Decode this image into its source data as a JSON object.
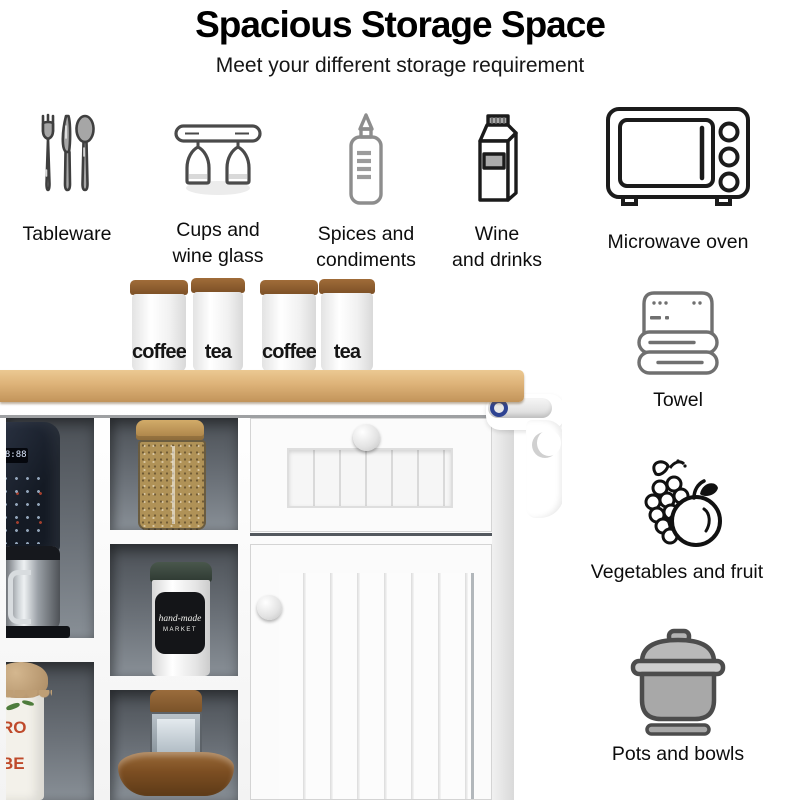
{
  "header": {
    "title": "Spacious Storage Space",
    "subtitle": "Meet your different storage requirement"
  },
  "features": {
    "tableware": {
      "label": "Tableware",
      "icon": "cutlery-icon"
    },
    "cups": {
      "label": "Cups and\nwine glass",
      "icon": "wine-glass-rack-icon"
    },
    "spices": {
      "label": "Spices and\ncondiments",
      "icon": "squeeze-bottle-icon"
    },
    "wine": {
      "label": "Wine\nand drinks",
      "icon": "drink-carton-icon"
    },
    "microwave": {
      "label": "Microwave oven",
      "icon": "microwave-icon"
    },
    "towel": {
      "label": "Towel",
      "icon": "folded-towel-icon"
    },
    "vegetables": {
      "label": "Vegetables and fruit",
      "icon": "grapes-and-apple-icon"
    },
    "pots": {
      "label": "Pots and bowls",
      "icon": "cooking-pot-icon"
    }
  },
  "photo": {
    "canisters": [
      "coffee",
      "tea",
      "coffee",
      "tea"
    ],
    "coffee_machine": {
      "display": "88:88"
    },
    "handmade_jar": {
      "line1": "hand-made",
      "line2": "MARKET"
    },
    "bean_jar": {
      "line1": "RO",
      "line2": "BE"
    }
  },
  "colors": {
    "counter_wood": "#ddb278",
    "lid_wood": "#8f5f33",
    "cubby_gray": "#6b7178",
    "icon_black": "#1b1b1b",
    "icon_gray": "#707070",
    "cabinet_white": "#f8f8f8"
  }
}
